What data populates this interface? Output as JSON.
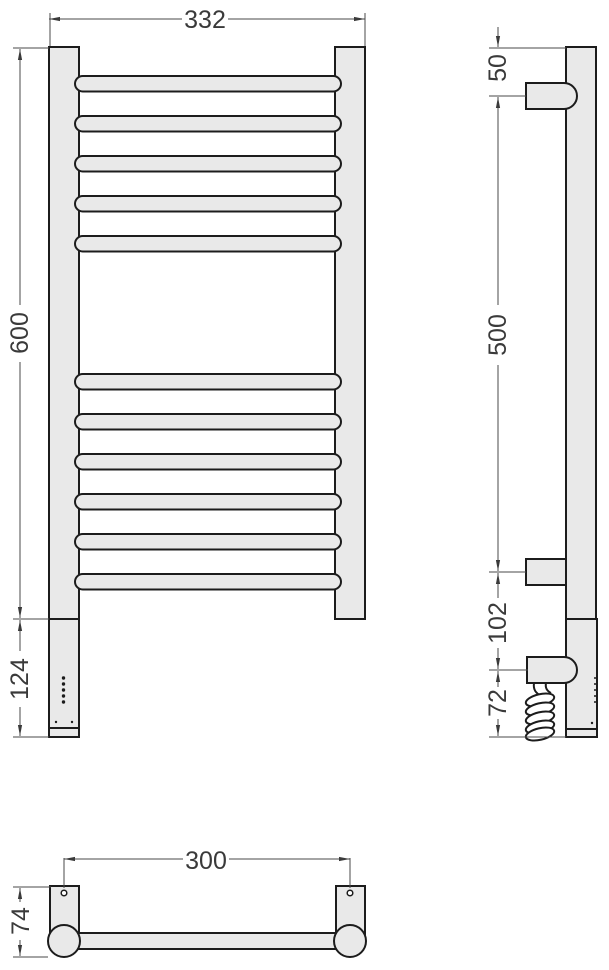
{
  "drawing_type": "towel-rail-technical-drawing",
  "colors": {
    "background": "#ffffff",
    "part_fill": "#e9e9e9",
    "part_outline": "#1c1c1c",
    "dimension_line": "#4a4a4a",
    "dimension_text": "#3a3a3a"
  },
  "front_view": {
    "width_label": "332",
    "height_label": "600",
    "lower_section_height_label": "124"
  },
  "side_view": {
    "top_bracket_offset_label": "50",
    "bracket_spacing_label": "500",
    "heater_bracket_offset_label": "102",
    "cable_offset_label": "72"
  },
  "bottom_view": {
    "mounting_distance_label": "300",
    "depth_label": "74"
  }
}
